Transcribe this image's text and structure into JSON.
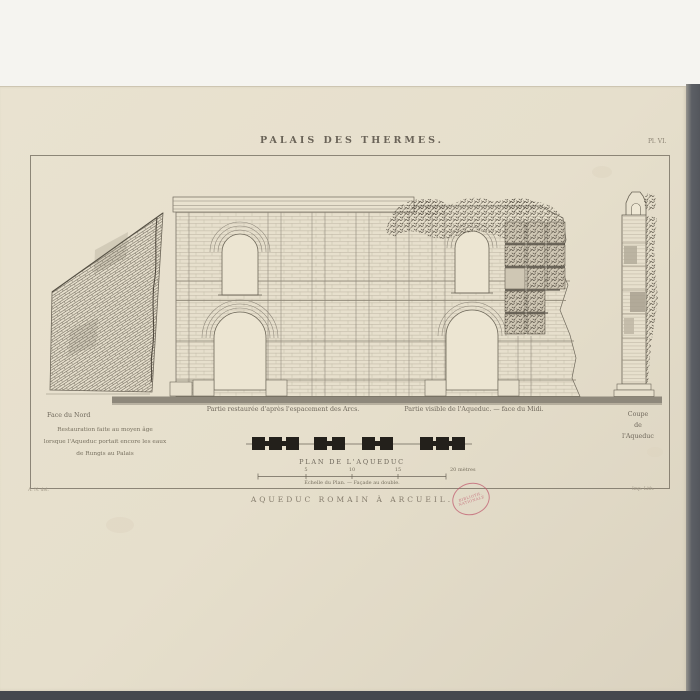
{
  "plate": {
    "title": "PALAIS DES THERMES.",
    "plate_number": "Pl. VI.",
    "bottom_caption": "AQUEDUC ROMAIN À ARCUEIL."
  },
  "figures": {
    "north_face": {
      "label": "Face du Nord",
      "note_line1": "Restauration faite au moyen âge",
      "note_line2": "lorsque l'Aqueduc portait encore les eaux",
      "note_line3": "de Rungis au Palais"
    },
    "elevation": {
      "restored_label": "Partie restaurée d'après l'espacement des Arcs.",
      "visible_label": "Partie visible de l'Aqueduc. — face du Midi."
    },
    "section": {
      "label_line1": "Coupe",
      "label_line2": "de",
      "label_line3": "l'Aqueduc"
    },
    "plan": {
      "title": "PLAN DE L'AQUEDUC",
      "scale_ticks": [
        "5",
        "10",
        "15",
        "20 mètres"
      ],
      "scale_caption": "Échelle du Plan. — Façade au double."
    }
  },
  "credits": {
    "left": "A. N. del.",
    "right": "Imp. Lith."
  },
  "stamp": {
    "line1": "BIBLIOTH.",
    "line2": "NATIONALE"
  },
  "colors": {
    "paper": "#e6dfcc",
    "ink": "#5f594e",
    "stamp_red": "#bf566b"
  }
}
